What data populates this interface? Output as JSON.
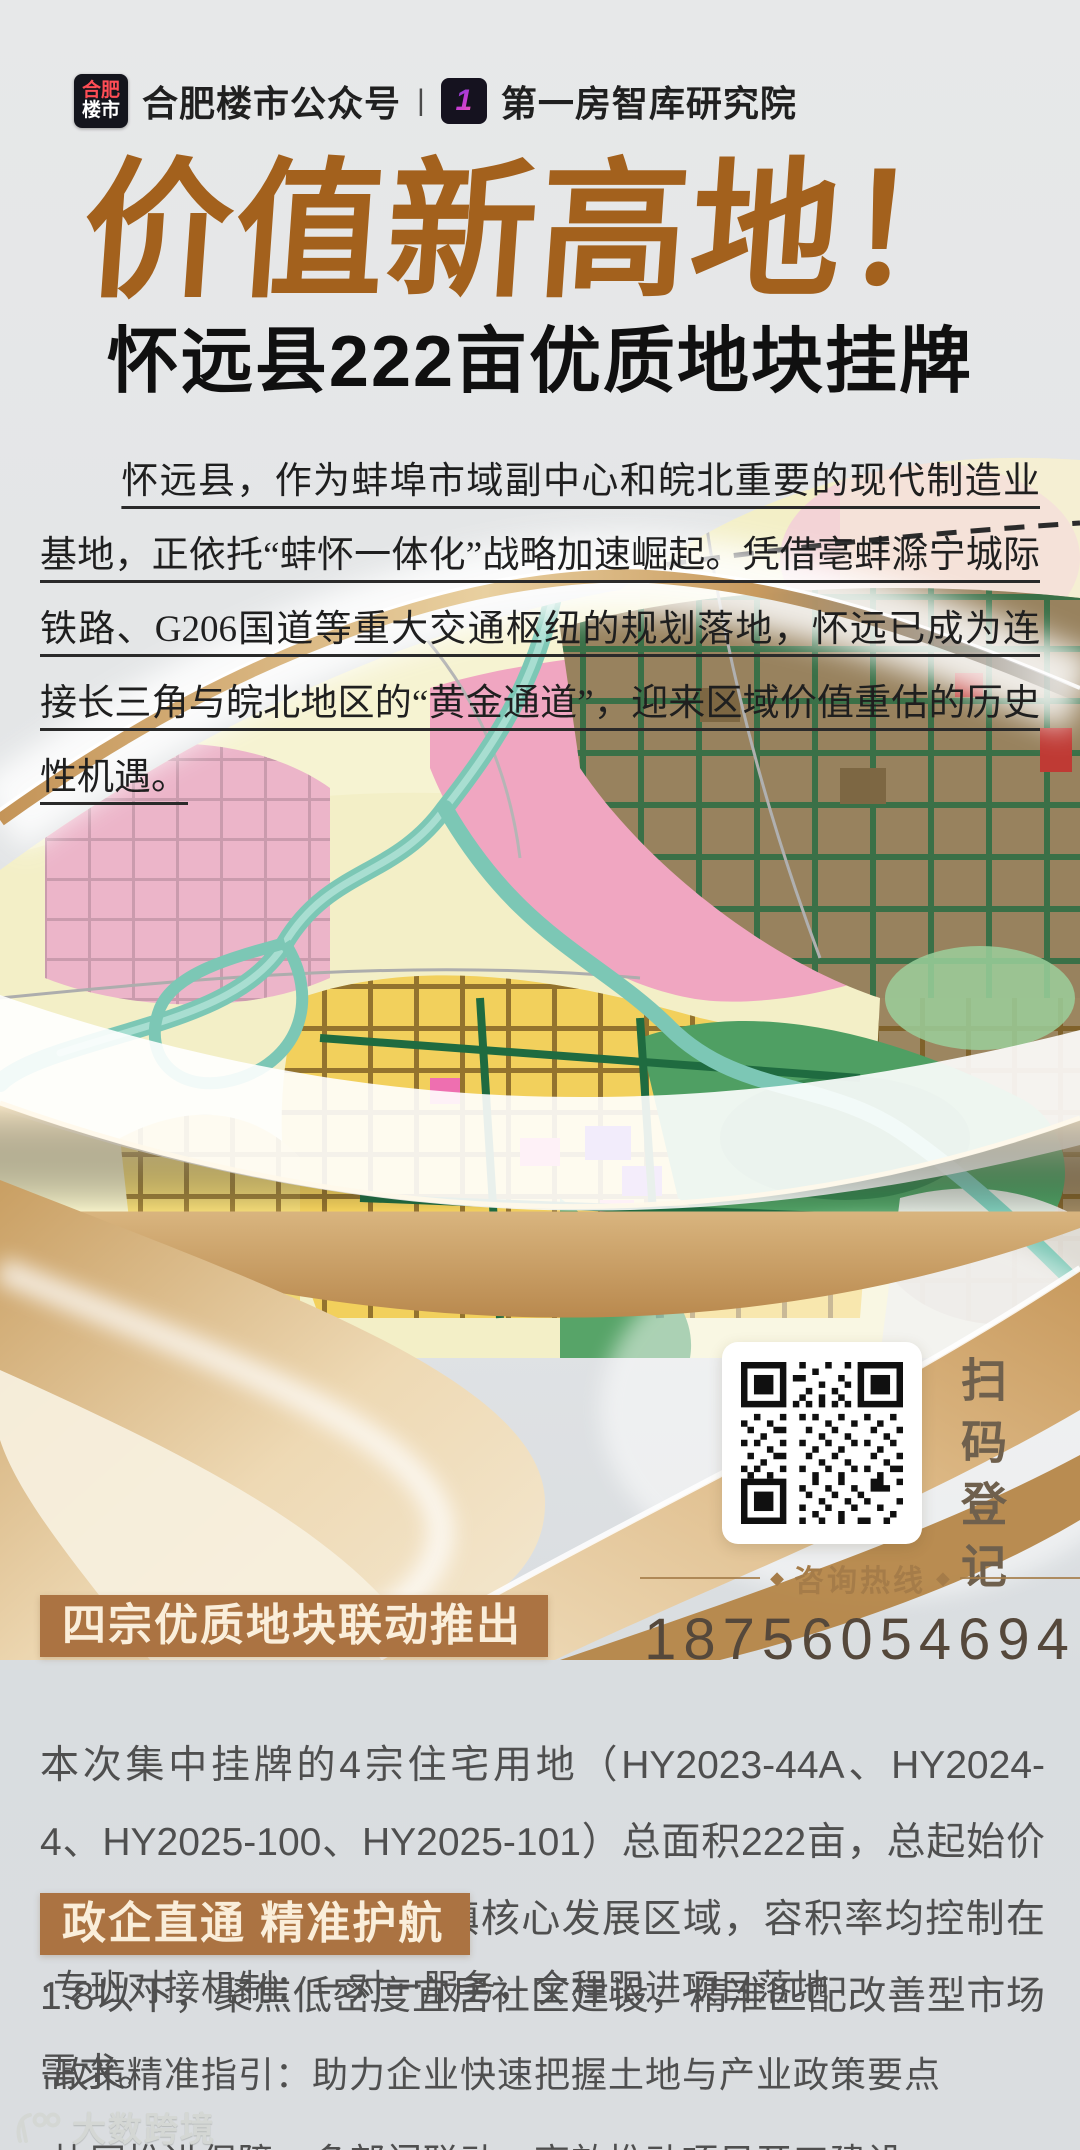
{
  "colors": {
    "title_brown": "#a3611d",
    "subtitle_black": "#101010",
    "intro_text": "#1f1f1f",
    "section_box_brown": "#ab7342",
    "section_box_text": "#faeeda",
    "body_text": "#4f4f4f",
    "hotline_gold": "#a57c49",
    "phone_brown": "#55483b",
    "scan_caption_brown": "#6f604d",
    "gold_accent": "#c89a5e"
  },
  "header": {
    "badge_top": "合肥",
    "badge_bottom": "楼市",
    "account_name": "合肥楼市公众号",
    "separator": "|",
    "logo_digit": "1",
    "org_name": "第一房智库研究院"
  },
  "hero": {
    "title": "价值新高地！",
    "subtitle": "怀远县222亩优质地块挂牌",
    "intro": "怀远县，作为蚌埠市域副中心和皖北重要的现代制造业基地，正依托“蚌怀一体化”战略加速崛起。凭借亳蚌滁宁城际铁路、G206国道等重大交通枢纽的规划落地，怀远已成为连接长三角与皖北地区的“黄金通道”，迎来区域价值重估的历史性机遇。"
  },
  "qr": {
    "caption": "扫码登记"
  },
  "hotline": {
    "label": "咨询热线",
    "phone": "18756054694"
  },
  "parcels_section": {
    "title": "四宗优质地块联动推出",
    "body": "本次集中挂牌的4宗住宅用地（HY2023-44A、HY2024-4、HY2025-100、HY2025-101）总面积222亩，总起始价3.29亿元，均位于荆山镇核心发展区域，容积率均控制在1.8以下，聚焦低密度宜居社区建设，精准匹配改善型市场需求。"
  },
  "service_section": {
    "title": "政企直通 精准护航",
    "bullets": [
      "·专班对接机制：一对一服务，全程跟进项目落地",
      "·政策精准指引：助力企业快速把握土地与产业政策要点",
      "·协同推进保障：多部门联动，高效推动项目开工建设"
    ]
  },
  "watermark": {
    "text": "大数跨境"
  }
}
